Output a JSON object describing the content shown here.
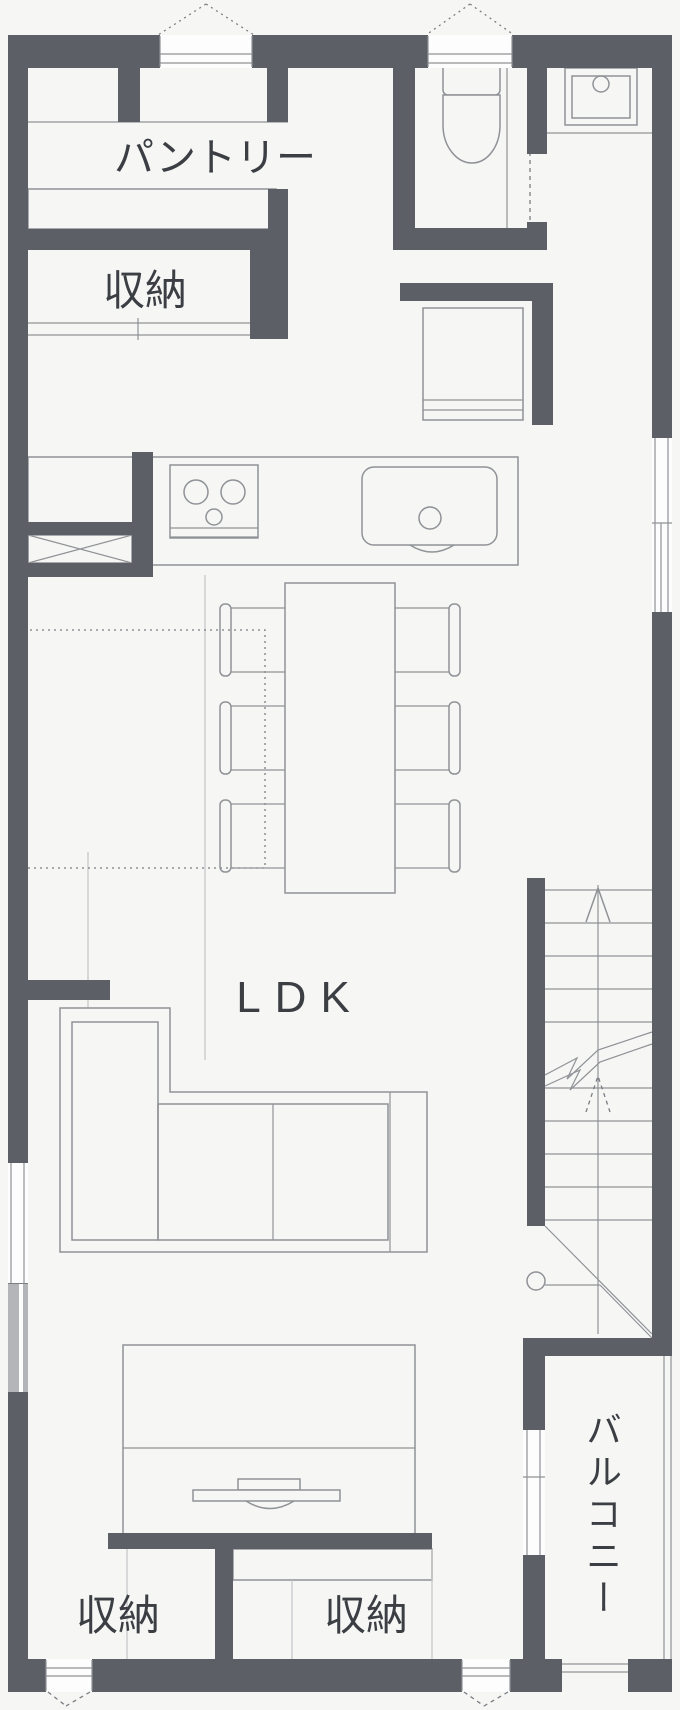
{
  "title": "1F floor plan (間取り図)",
  "colors": {
    "wall": "#5c6066",
    "line": "#8f9296",
    "lightline": "#c4c5c7",
    "dash": "#7a7d82",
    "text": "#3b3e43",
    "bg": "#f6f6f5",
    "window": "#fdfdfd",
    "band": "#b3b5b8"
  },
  "labels": {
    "pantry": "パントリー",
    "storage_top": "収納",
    "ldk": "LDK",
    "balcony": "バルコニー",
    "storage_bottom_left": "収納",
    "storage_bottom_right": "収納"
  },
  "fixtures": [
    "toilet-icon",
    "utility-sink-icon",
    "washbasin-cabinet-icon",
    "gas-stove-icon",
    "kitchen-sink-icon",
    "crosshatch-cabinet-icon",
    "dining-table-icon",
    "dining-chair-icon",
    "sofa-icon",
    "tv-board-icon",
    "tv-icon",
    "staircase-icon",
    "stair-up-arrow-icon",
    "balcony-railing",
    "window-opening-marks"
  ],
  "stairs": {
    "direction": "up"
  }
}
